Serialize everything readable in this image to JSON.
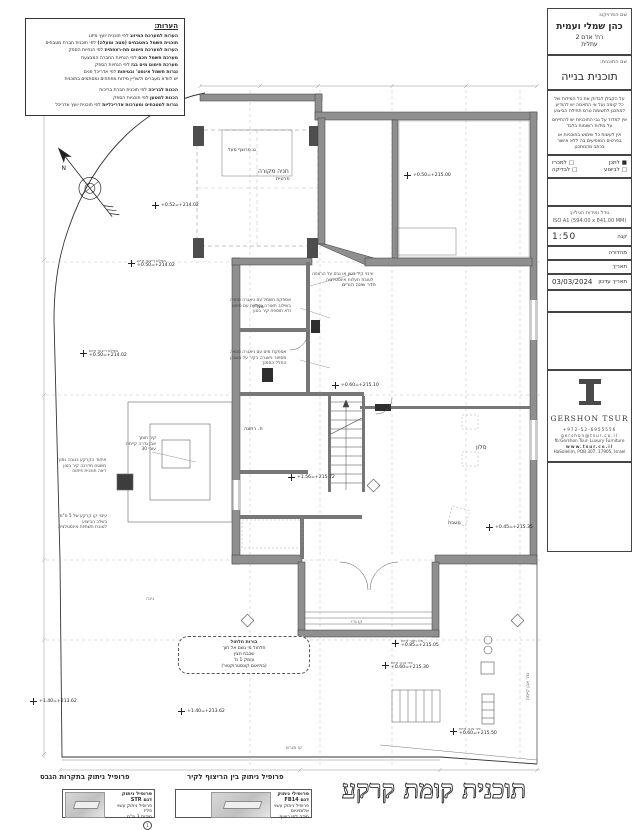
{
  "title_block": {
    "project_label": "שם הפרויקט:",
    "project_name": "כהן שמלי ועמית",
    "address1": "רח' אדם 2",
    "address2": "עתלית",
    "plan_label": "שם התוכנית:",
    "plan_name": "תוכנית בנייה",
    "disclaimer1": "על הקבלן לבדוק את כל המידות של כל קומה ועל אי התאמה יש להודיע למתכנן לתשומת טרם תחילת הביצוע",
    "disclaimer2": "אין למדוד על גבי התוכניות יש להתייחס על מידות רשומות בלבד",
    "disclaimer3": "אין לעשות כל שימוש בתוכניות או בפרטים המופיעים בה ללא אישור בכתב מהמתכנן",
    "checks": [
      {
        "box": "■",
        "label": "לתכן"
      },
      {
        "box": "□",
        "label": "למכרז"
      },
      {
        "box": "□",
        "label": "לביצוע"
      },
      {
        "box": "□",
        "label": "לבדיקה"
      }
    ],
    "sheet_size_label": "גודל ומידות הגיליון:",
    "sheet_size_value": "ISO A1 (594.00 x 841.00 MM)",
    "scale_label": "קנה",
    "scale_value": "1:50",
    "edition_label": "מהדורה",
    "date_label": "תאריך",
    "updated_label": "תאריך עדכון",
    "updated_value": "03/03/2024",
    "logo_name": "GERSHON TSUR",
    "contact1": "+972-52-6955556",
    "contact2": "gershon@tsur.co.il",
    "contact3": "fb:Gershon Tsur- Luxury Furniture",
    "contact4": "www.tsur.co.il",
    "contact5": "HaSolelim, POB 307, 17905, Israel"
  },
  "notes": {
    "title": "הערות:",
    "lines": [
      {
        "b": "הערות למערכת המיזוג",
        "r": "  לפי תוכנית יועץ מיזוג"
      },
      {
        "b": "תוכנית חשמל במטבחים (מטה ומעלה)",
        "r": "  לפי תוכנית חברת מטבחים"
      },
      {
        "b": "הערות למערכת חימום תת-רצפתית",
        "r": "  לפי הנחיות הספק"
      },
      {
        "b": "מערכת חשמל חכם",
        "r": "  לפי הנחיות החברה המבצעת"
      },
      {
        "b": "מערכת חימום מים בגז",
        "r": "  לפי הנחיות הספק"
      },
      {
        "b": "נגרות חשמל אינסט' ובטיחות",
        "r": "  לפי אדריכל פנים"
      },
      {
        "b": "",
        "r": "יש לוודא מעברים ולשריין מידות מפתחים ומסתמים בתוכנית"
      },
      {
        "b": "הכנות לבריכה",
        "r": "  לפי תוכנית חברת בריכות"
      },
      {
        "b": "הכנות למטען",
        "r": "  לפי תוכניות הספק"
      },
      {
        "b": "נגרות למטבחים ומערכות אדריכליות",
        "r": "  לפי תוכנית יועץ אדריכל"
      }
    ]
  },
  "plan": {
    "title": "תוכנית קומת קרקע",
    "labels": [
      {
        "text": "חניה מקורה"
      },
      {
        "text": "פרטית"
      },
      {
        "text": "גג מרוצף מעל"
      },
      {
        "text": "חדר שינה הורים"
      },
      {
        "text": "ממ\"ד"
      },
      {
        "text": "ח. רחצה"
      },
      {
        "text": "סלון"
      },
      {
        "text": "מטבח"
      },
      {
        "text": "גינה"
      },
      {
        "text": "גדר אבן קיימת"
      },
      {
        "text": "קו מגרש"
      },
      {
        "text": "קו גדר"
      }
    ],
    "markers": [
      {
        "v": "+0.50=+215.00",
        "l": ""
      },
      {
        "v": "+0.52=+214.02",
        "l": ""
      },
      {
        "v": "+0.50=+214.02",
        "l": "מפלס ריצוף קיים"
      },
      {
        "v": "+0.50=+214.02",
        "l": "מפלס ריצוף קיים"
      },
      {
        "v": "+1.40=+213.62",
        "l": ""
      },
      {
        "v": "+1.40=+213.62",
        "l": ""
      },
      {
        "v": "+0.85=+215.05",
        "l": "פני חצר קיים"
      },
      {
        "v": "+0.60=+215.30",
        "l": "פני גינה קיים"
      },
      {
        "v": "+0.60=+215.50",
        "l": "פני גינה קיים"
      },
      {
        "v": "+0.45=+215.35",
        "l": ""
      },
      {
        "v": "+0.60=+215.10",
        "l": ""
      },
      {
        "v": "+1.56=+215.72",
        "l": ""
      }
    ],
    "annotations": [
      {
        "l1": "עיבוי קיר בטון או גבס על הרצפה",
        "l2": "לטובת תעלות אינסטלציה",
        "l3": ""
      },
      {
        "l1": "אספקת חשמל עם ניאגרה סמויה",
        "l2": "בשילוב תאורה נסתרת עם ספוט",
        "l3": "ולא תוספת קיר בטון"
      },
      {
        "l1": "אספקת מים עם ניאגרה סמויה",
        "l2": "מסתור ניאגרה בקיר על חשבון",
        "l3": "החלל הסמוך"
      },
      {
        "l1": "איחוד הקרקע בגובה נמוך",
        "l2": "משטח מדרגה קיר בטון",
        "l3": "ראה תוכנית פיתוח"
      },
      {
        "l1": "קיר תומך",
        "l2": "אבן גדרה קיימת",
        "l3": "עובי 30"
      },
      {
        "l1": "עיבוי קו קרקע של 5 ס\"מ",
        "l2": "בשלב הביצוע",
        "l3": "לטובת תשתיות אינסטלציה"
      }
    ],
    "bubble": {
      "l1": "בורות חלחול",
      "l2": "חלחול מי גשם אל תוך",
      "l3": "שכבת חצץ",
      "l4": "עומק 1 מ'",
      "l5": "(בתיאום קונסטרוקטור)"
    }
  },
  "details": {
    "right": {
      "title": "פרופיל ניתוק בין הריצוף לקיר",
      "name": "פרופילי ניתוק",
      "model": "דגם FB14",
      "line1": "פרופיל ניתוק עשוי",
      "line2": "אלומיניום",
      "line3": "מידה לפי ריצוף"
    },
    "left": {
      "title": "פרופיל ניתוק בתקרות הגבס",
      "name": "פרופיל ניתוק",
      "model": "דגם STR",
      "line1": "פרופיל ניתוק עשוי פליז",
      "line2": "מידות 3 מ\"מ",
      "line3": "עובי 10 מ\"מ"
    }
  }
}
